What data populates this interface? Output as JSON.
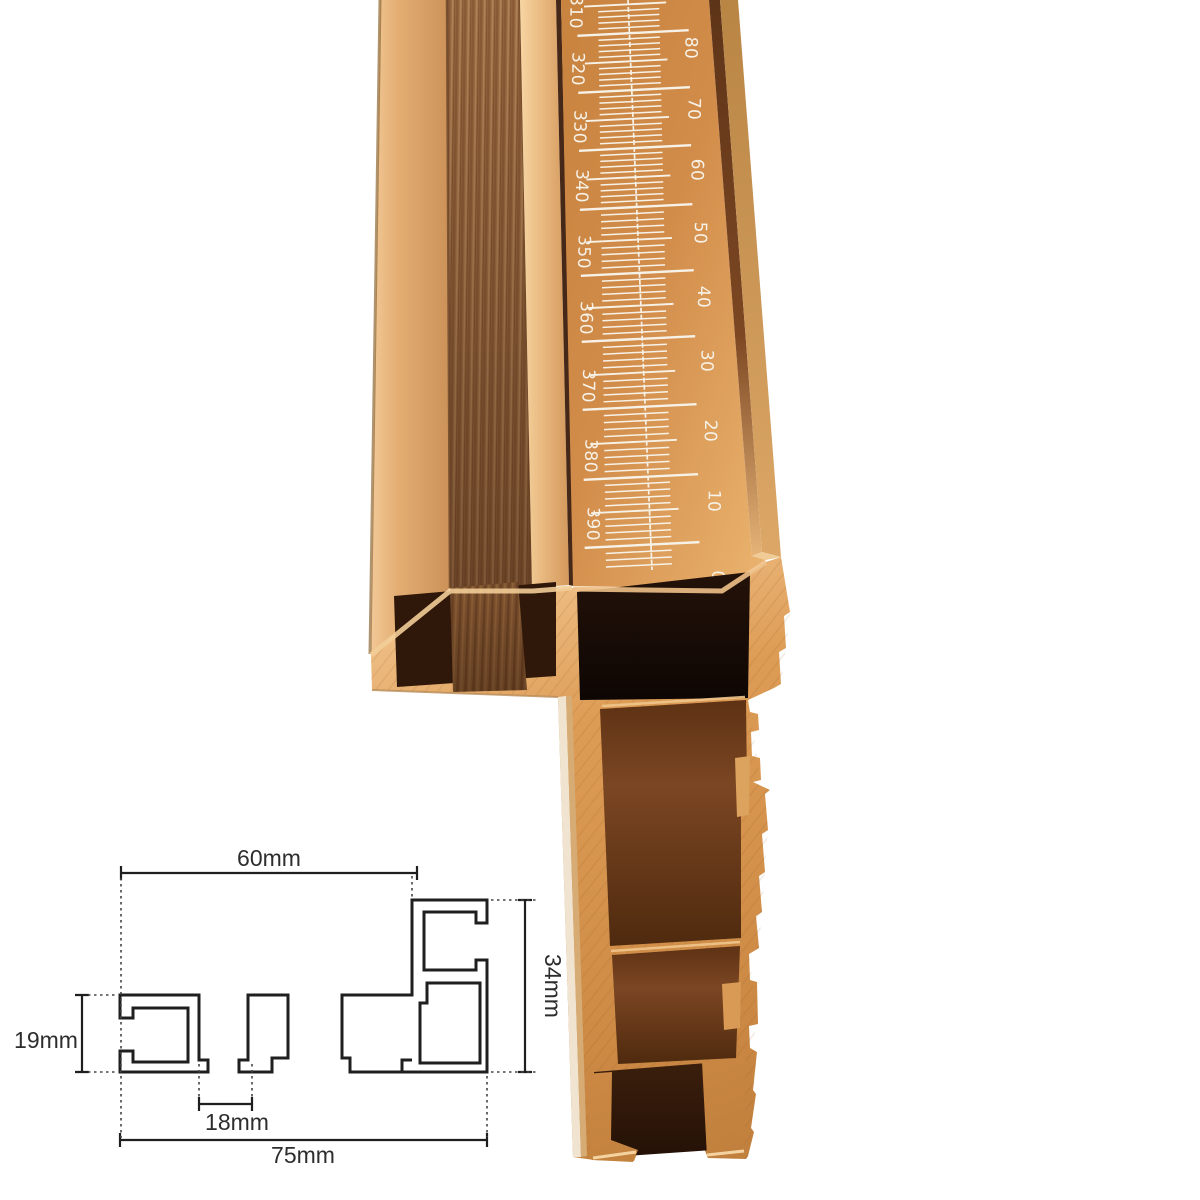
{
  "scene": {
    "background": "#ffffff"
  },
  "ruler": {
    "left_scale": [
      "310",
      "320",
      "330",
      "340",
      "350",
      "360",
      "370",
      "380",
      "390"
    ],
    "right_scale": [
      "80",
      "70",
      "60",
      "50",
      "40",
      "30",
      "20",
      "10",
      "0"
    ],
    "mark_color": "#f7f2e8"
  },
  "colors": {
    "aluminum_light": "#e9b77f",
    "aluminum_mid": "#d79251",
    "aluminum_deep": "#bf7c3a",
    "brushed_channel": "#9c6d44",
    "groove_shadow": "#452817",
    "cavity_black": "#150b05",
    "cavity_brown": "#6f3e1c",
    "channel_dark": "#2f180a",
    "left_wall_light": "#f0e3cf",
    "background": "#ffffff"
  },
  "diagram": {
    "top_width": "60mm",
    "right_height": "34mm",
    "left_height": "19mm",
    "slot_width": "18mm",
    "total_width": "75mm",
    "line_color": "#1f1f1f",
    "label_color": "#2d2d2d"
  }
}
